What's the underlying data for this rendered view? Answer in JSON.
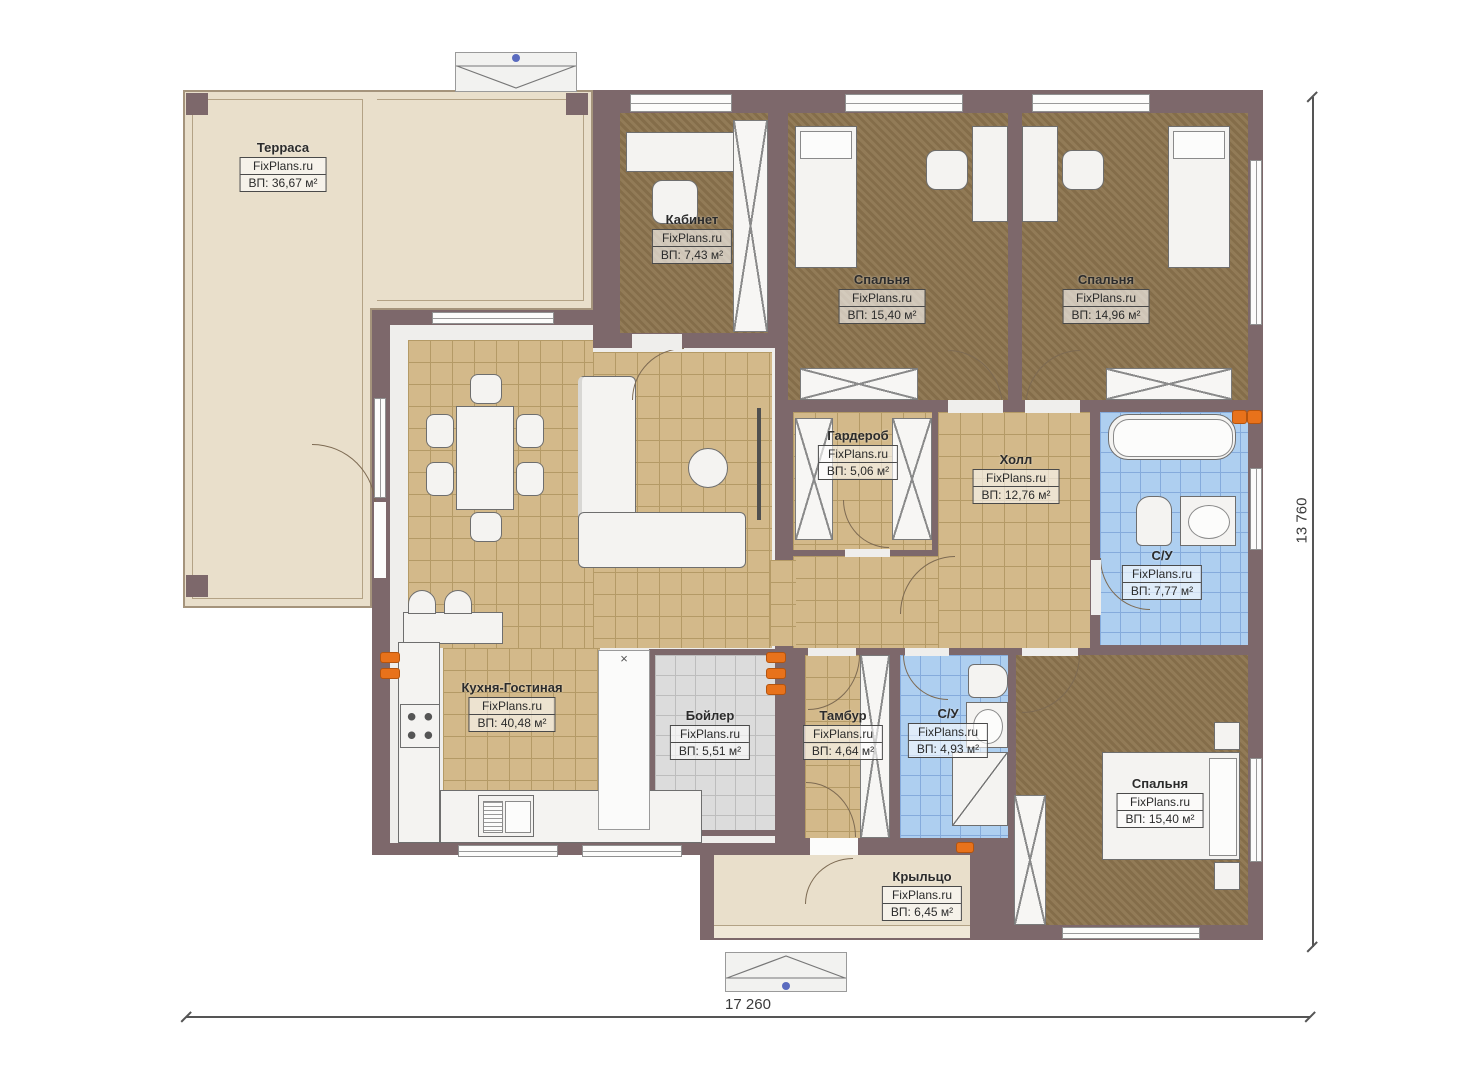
{
  "watermark": "FixPlans.ru",
  "rooms": [
    {
      "id": "terrace",
      "name": "Терраса",
      "area": "ВП: 36,67 м²"
    },
    {
      "id": "office",
      "name": "Кабинет",
      "area": "ВП: 7,43 м²"
    },
    {
      "id": "bedroom-top-left",
      "name": "Спальня",
      "area": "ВП: 15,40 м²"
    },
    {
      "id": "bedroom-top-right",
      "name": "Спальня",
      "area": "ВП: 14,96 м²"
    },
    {
      "id": "wardrobe",
      "name": "Гардероб",
      "area": "ВП: 5,06 м²"
    },
    {
      "id": "hall",
      "name": "Холл",
      "area": "ВП: 12,76 м²"
    },
    {
      "id": "bathroom-main",
      "name": "С/У",
      "area": "ВП: 7,77 м²"
    },
    {
      "id": "kitchen-living",
      "name": "Кухня-Гостиная",
      "area": "ВП: 40,48 м²"
    },
    {
      "id": "boiler",
      "name": "Бойлер",
      "area": "ВП: 5,51 м²"
    },
    {
      "id": "vestibule",
      "name": "Тамбур",
      "area": "ВП: 4,64 м²"
    },
    {
      "id": "bathroom-small",
      "name": "С/У",
      "area": "ВП: 4,93 м²"
    },
    {
      "id": "bedroom-bottom",
      "name": "Спальня",
      "area": "ВП: 15,40 м²"
    },
    {
      "id": "porch",
      "name": "Крыльцо",
      "area": "ВП: 6,45 м²"
    }
  ],
  "dimensions": {
    "width_label": "17 260",
    "height_label": "13 760"
  },
  "symbols": {
    "shaft_mark": "×"
  },
  "colors": {
    "wall": "#7d686b",
    "terrace_floor": "#e9dfcb",
    "room_floor_brown": "#8c744e",
    "tile_tan": "#d3b98a",
    "tile_blue": "#aecff0",
    "tile_gray": "#dcdcdc",
    "radiator_accent": "#e8721b",
    "marker_dot": "#5a6bbf"
  }
}
